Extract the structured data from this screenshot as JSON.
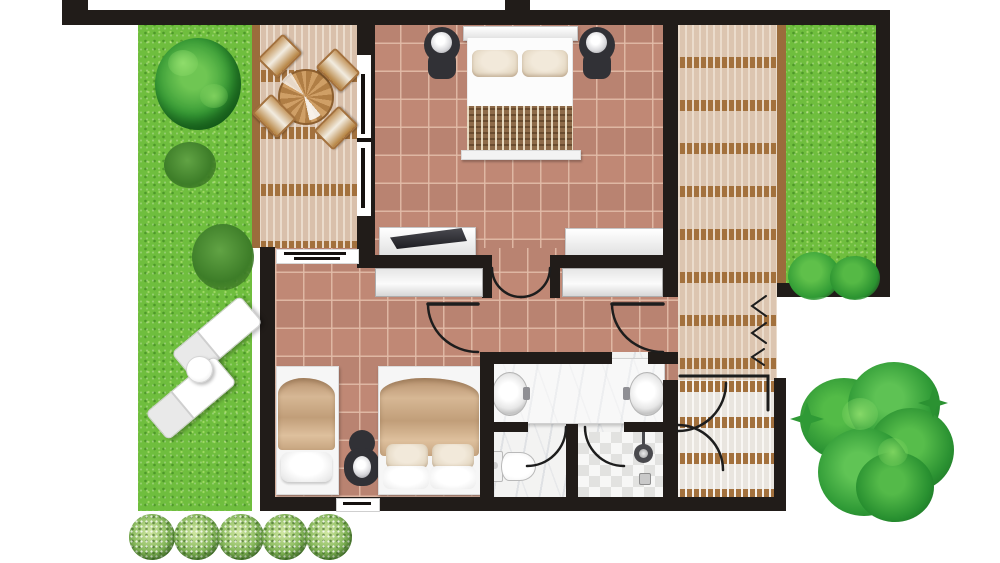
{
  "title": "Hotel villa suite floor plan, top-down view with gardens and timber decks",
  "palette": {
    "wall": "#211c19",
    "terracotta_tile": "#c08875",
    "tile_grout": "#d4a38f",
    "deck_wood": "#dcc5b0",
    "deck_joist_brown": "#a3713d",
    "deck_beam": "#9b6c3c",
    "grass_green": "#6fbe3e",
    "tree_green": "#2f9e37",
    "bush_green": "#84b858",
    "marble_white": "#f3f3f2",
    "furniture_white": "#fafafa",
    "blanket_tan": "#c9a98b",
    "bedspread_brown": "#8d6a49",
    "lamp_dark": "#313136"
  },
  "rooms": [
    {
      "name": "master-bedroom",
      "floor": "terracotta tile",
      "furniture": [
        "double-bed with two pillows and patterned runner",
        "nightstand-with-lamp left",
        "nightstand-with-lamp right",
        "tv-console with flat tv",
        "dresser"
      ]
    },
    {
      "name": "hallway",
      "floor": "terracotta tile",
      "features": [
        "double-entry-door from master bedroom",
        "built-in-closet left",
        "built-in-closet right",
        "door to second bedroom",
        "door to bathroom"
      ]
    },
    {
      "name": "second-bedroom",
      "floor": "terracotta tile",
      "furniture": [
        "single-bed",
        "shared-nightstand-with-lamp",
        "double-bed with two pillows"
      ],
      "features": [
        "window to deck (north)",
        "window in south wall"
      ]
    },
    {
      "name": "bathroom",
      "floor": "marble",
      "furniture": [
        "double-vanity with two round basins",
        "wc-toilet in separate compartment",
        "shower with mosaic floor, shower-head and drain"
      ]
    }
  ],
  "outdoor": [
    {
      "name": "left-garden",
      "items": [
        "large-round-tree",
        "shrub",
        "shrub",
        "two-sun-loungers",
        "round-side-table"
      ]
    },
    {
      "name": "left-deck",
      "items": [
        "round-dining-table",
        "four-wooden-chairs",
        "pergola joists"
      ]
    },
    {
      "name": "right-deck",
      "items": [
        "entry steps with direction chevrons",
        "double-door swing to deck"
      ]
    },
    {
      "name": "right-garden",
      "items": [
        "hedge bushes at wall"
      ]
    },
    {
      "name": "south-hedge",
      "items": [
        "bush",
        "bush",
        "bush",
        "bush",
        "bush"
      ]
    },
    {
      "name": "south-east-tree",
      "items": [
        "large leafy tree"
      ]
    }
  ],
  "doors": [
    {
      "name": "master-to-hall-double-door"
    },
    {
      "name": "hall-to-bedroom2-door"
    },
    {
      "name": "hall-to-bathroom-door"
    },
    {
      "name": "wc-compartment-door"
    },
    {
      "name": "shower-door"
    },
    {
      "name": "hall-to-deck-double-door"
    }
  ]
}
